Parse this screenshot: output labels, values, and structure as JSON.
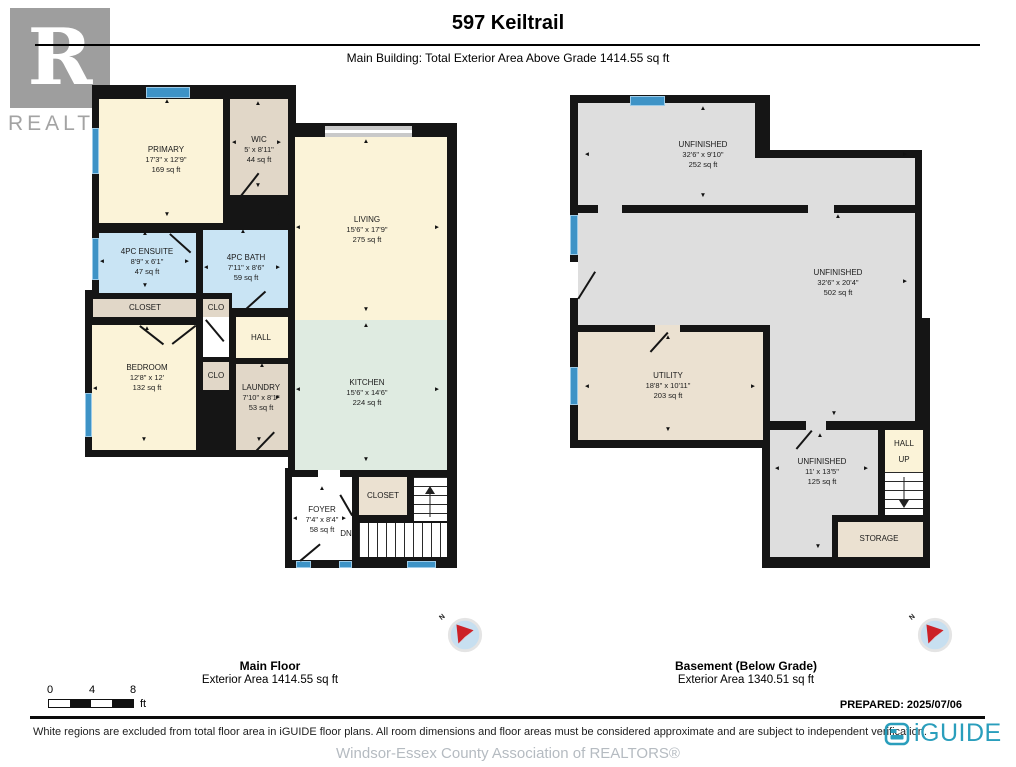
{
  "header": {
    "title": "597 Keiltrail",
    "subtitle": "Main Building: Total Exterior Area Above Grade 1414.55 sq ft"
  },
  "watermark": {
    "letter": "R",
    "label": "REALTOR",
    "reg": "®"
  },
  "colors": {
    "wall": "#151515",
    "cream": "#FBF3D8",
    "tan": "#E1D7C8",
    "tan2": "#EBE1D1",
    "bath_blue": "#C9E4F4",
    "kitchen_mint": "#DFEBE1",
    "unfinished_gray": "#DEDEDE",
    "window_blue": "#3E93C6",
    "iguide_teal": "#2A9EBC",
    "compass_red": "#CC2127"
  },
  "plans": [
    {
      "id": "main-floor",
      "caption": {
        "title": "Main Floor",
        "area": "Exterior Area 1414.55 sq ft",
        "x": 270,
        "y": 658
      },
      "compass": {
        "x": 465,
        "y": 635,
        "label": "N"
      },
      "slabs": [
        [
          92,
          85,
          204,
          242
        ],
        [
          85,
          290,
          211,
          167
        ],
        [
          288,
          123,
          169,
          357
        ],
        [
          285,
          468,
          172,
          100
        ]
      ],
      "fills": [
        {
          "k": "cream",
          "r": [
            99,
            99,
            124,
            124
          ]
        },
        {
          "k": "tan",
          "r": [
            230,
            99,
            58,
            96
          ]
        },
        {
          "k": "cream",
          "r": [
            295,
            137,
            152,
            183
          ]
        },
        {
          "k": "mint",
          "r": [
            295,
            320,
            152,
            150
          ]
        },
        {
          "k": "blue",
          "r": [
            99,
            233,
            97,
            60
          ]
        },
        {
          "k": "blue",
          "r": [
            203,
            230,
            85,
            63
          ]
        },
        {
          "k": "blue",
          "r": [
            232,
            293,
            56,
            15
          ]
        },
        {
          "k": "tan",
          "r": [
            93,
            299,
            103,
            18
          ]
        },
        {
          "k": "tan",
          "r": [
            203,
            299,
            26,
            18
          ]
        },
        {
          "k": "white",
          "r": [
            203,
            317,
            26,
            40
          ]
        },
        {
          "k": "cream",
          "r": [
            236,
            317,
            52,
            41
          ]
        },
        {
          "k": "cream",
          "r": [
            92,
            325,
            104,
            125
          ]
        },
        {
          "k": "tan",
          "r": [
            203,
            362,
            26,
            28
          ]
        },
        {
          "k": "tan",
          "r": [
            236,
            364,
            52,
            86
          ]
        },
        {
          "k": "white",
          "r": [
            292,
            477,
            60,
            83
          ]
        },
        {
          "k": "tan2",
          "r": [
            359,
            477,
            48,
            38
          ]
        },
        {
          "k": "white",
          "r": [
            318,
            470,
            22,
            8
          ]
        }
      ],
      "windows": [
        [
          146,
          87,
          44,
          11
        ],
        [
          92,
          128,
          7,
          46
        ],
        [
          92,
          238,
          7,
          42
        ],
        [
          85,
          393,
          7,
          44
        ],
        [
          296,
          561,
          15,
          7
        ],
        [
          339,
          561,
          13,
          7
        ],
        [
          407,
          561,
          29,
          7
        ]
      ],
      "sliders": [
        [
          325,
          126,
          87,
          11
        ]
      ],
      "doors": [
        {
          "x": 240,
          "y": 196,
          "len": 30,
          "deg": -52
        },
        {
          "x": 266,
          "y": 198,
          "len": 30,
          "deg": 48
        },
        {
          "x": 170,
          "y": 233,
          "len": 28,
          "deg": 42
        },
        {
          "x": 246,
          "y": 308,
          "len": 26,
          "deg": -42
        },
        {
          "x": 206,
          "y": 319,
          "len": 28,
          "deg": 50
        },
        {
          "x": 140,
          "y": 325,
          "len": 30,
          "deg": 38
        },
        {
          "x": 196,
          "y": 325,
          "len": 30,
          "deg": 142
        },
        {
          "x": 256,
          "y": 450,
          "len": 26,
          "deg": -46
        },
        {
          "x": 300,
          "y": 560,
          "len": 26,
          "deg": -40
        },
        {
          "x": 352,
          "y": 515,
          "len": 24,
          "deg": -120
        }
      ],
      "stairs": [
        {
          "r": [
            414,
            477,
            33,
            44
          ],
          "dir": "h"
        },
        {
          "r": [
            359,
            523,
            88,
            34
          ],
          "dir": "v"
        }
      ],
      "stair_arrows": [
        {
          "x": 430,
          "y1": 517,
          "y2": 487
        }
      ],
      "markers": [
        [
          "▲",
          167,
          102
        ],
        [
          "▲",
          258,
          104
        ],
        [
          "▲",
          366,
          142
        ],
        [
          "▲",
          366,
          326
        ],
        [
          "▲",
          243,
          232
        ],
        [
          "▲",
          145,
          234
        ],
        [
          "▲",
          322,
          489
        ],
        [
          "▲",
          262,
          366
        ],
        [
          "▲",
          147,
          329
        ],
        [
          "▼",
          167,
          215
        ],
        [
          "▼",
          258,
          186
        ],
        [
          "▼",
          366,
          310
        ],
        [
          "▼",
          366,
          460
        ],
        [
          "▼",
          145,
          286
        ],
        [
          "▼",
          144,
          440
        ],
        [
          "▼",
          259,
          440
        ],
        [
          "◄",
          234,
          143
        ],
        [
          "◄",
          298,
          228
        ],
        [
          "◄",
          298,
          390
        ],
        [
          "◄",
          102,
          262
        ],
        [
          "◄",
          206,
          268
        ],
        [
          "◄",
          95,
          389
        ],
        [
          "◄",
          295,
          519
        ],
        [
          "►",
          279,
          143
        ],
        [
          "►",
          437,
          228
        ],
        [
          "►",
          437,
          390
        ],
        [
          "►",
          187,
          262
        ],
        [
          "►",
          278,
          268
        ],
        [
          "►",
          278,
          398
        ],
        [
          "►",
          344,
          519
        ]
      ],
      "labels": [
        {
          "n": "PRIMARY",
          "d": "17'3\" x 12'9\"",
          "a": "169 sq ft",
          "x": 166,
          "y": 160
        },
        {
          "n": "WIC",
          "d": "5' x 8'11\"",
          "a": "44 sq ft",
          "x": 259,
          "y": 150
        },
        {
          "n": "LIVING",
          "d": "15'6\" x 17'9\"",
          "a": "275 sq ft",
          "x": 367,
          "y": 230
        },
        {
          "n": "KITCHEN",
          "d": "15'6\" x 14'6\"",
          "a": "224 sq ft",
          "x": 367,
          "y": 393
        },
        {
          "n": "4PC ENSUITE",
          "d": "8'9\" x 6'1\"",
          "a": "47 sq ft",
          "x": 147,
          "y": 262
        },
        {
          "n": "4PC BATH",
          "d": "7'11\" x 8'6\"",
          "a": "59 sq ft",
          "x": 246,
          "y": 268
        },
        {
          "n": "CLOSET",
          "x": 145,
          "y": 308
        },
        {
          "n": "CLO",
          "x": 216,
          "y": 308
        },
        {
          "n": "HALL",
          "x": 261,
          "y": 338
        },
        {
          "n": "BEDROOM",
          "d": "12'8\" x 12'",
          "a": "132 sq ft",
          "x": 147,
          "y": 378
        },
        {
          "n": "CLO",
          "x": 216,
          "y": 376
        },
        {
          "n": "LAUNDRY",
          "d": "7'10\" x 8'1\"",
          "a": "53 sq ft",
          "x": 261,
          "y": 398
        },
        {
          "n": "FOYER",
          "d": "7'4\" x 8'4\"",
          "a": "58 sq ft",
          "x": 322,
          "y": 520
        },
        {
          "n": "CLOSET",
          "x": 383,
          "y": 496
        },
        {
          "n": "DN",
          "x": 346,
          "y": 534
        }
      ]
    },
    {
      "id": "basement",
      "caption": {
        "title": "Basement (Below Grade)",
        "area": "Exterior Area 1340.51 sq ft",
        "x": 746,
        "y": 658
      },
      "compass": {
        "x": 935,
        "y": 635,
        "label": "N"
      },
      "slabs": [
        [
          570,
          95,
          200,
          117
        ],
        [
          755,
          150,
          167,
          62
        ],
        [
          570,
          205,
          352,
          127
        ],
        [
          570,
          325,
          200,
          123
        ],
        [
          762,
          318,
          168,
          250
        ]
      ],
      "fills": [
        {
          "k": "gray",
          "r": [
            578,
            103,
            177,
            55
          ]
        },
        {
          "k": "gray",
          "r": [
            578,
            158,
            337,
            47
          ]
        },
        {
          "k": "gray",
          "r": [
            578,
            213,
            337,
            112
          ]
        },
        {
          "k": "gray",
          "r": [
            770,
            325,
            145,
            96
          ]
        },
        {
          "k": "tan2",
          "r": [
            578,
            332,
            185,
            108
          ]
        },
        {
          "k": "gray",
          "r": [
            770,
            430,
            108,
            85
          ]
        },
        {
          "k": "gray",
          "r": [
            770,
            430,
            62,
            127
          ]
        },
        {
          "k": "cream",
          "r": [
            885,
            430,
            38,
            42
          ]
        },
        {
          "k": "tan2",
          "r": [
            838,
            522,
            85,
            35
          ]
        },
        {
          "k": "gray",
          "r": [
            598,
            205,
            24,
            8
          ]
        },
        {
          "k": "gray",
          "r": [
            808,
            205,
            26,
            8
          ]
        },
        {
          "k": "tan2",
          "r": [
            655,
            325,
            25,
            7
          ]
        },
        {
          "k": "gray",
          "r": [
            806,
            421,
            20,
            9
          ]
        },
        {
          "k": "white",
          "r": [
            570,
            262,
            8,
            36
          ]
        }
      ],
      "windows": [
        [
          630,
          96,
          35,
          10
        ],
        [
          570,
          215,
          8,
          40
        ],
        [
          570,
          367,
          8,
          38
        ]
      ],
      "sliders": [],
      "doors": [
        {
          "x": 578,
          "y": 298,
          "len": 32,
          "deg": -58
        },
        {
          "x": 668,
          "y": 332,
          "len": 26,
          "deg": 132
        },
        {
          "x": 812,
          "y": 430,
          "len": 24,
          "deg": 130
        }
      ],
      "stairs": [
        {
          "r": [
            885,
            472,
            38,
            43
          ],
          "dir": "h"
        }
      ],
      "stair_arrows": [
        {
          "x": 904,
          "y1": 477,
          "y2": 507
        }
      ],
      "markers": [
        [
          "▲",
          703,
          109
        ],
        [
          "▲",
          838,
          217
        ],
        [
          "▲",
          668,
          338
        ],
        [
          "▲",
          820,
          436
        ],
        [
          "▼",
          703,
          196
        ],
        [
          "▼",
          834,
          414
        ],
        [
          "▼",
          668,
          430
        ],
        [
          "▼",
          818,
          547
        ],
        [
          "◄",
          587,
          155
        ],
        [
          "◄",
          587,
          387
        ],
        [
          "◄",
          777,
          469
        ],
        [
          "►",
          905,
          155
        ],
        [
          "►",
          905,
          282
        ],
        [
          "►",
          753,
          387
        ],
        [
          "►",
          866,
          469
        ]
      ],
      "labels": [
        {
          "n": "UNFINISHED",
          "d": "32'6\" x 9'10\"",
          "a": "252 sq ft",
          "x": 703,
          "y": 155
        },
        {
          "n": "UNFINISHED",
          "d": "32'6\" x 20'4\"",
          "a": "502 sq ft",
          "x": 838,
          "y": 283
        },
        {
          "n": "UTILITY",
          "d": "18'8\" x 10'11\"",
          "a": "203 sq ft",
          "x": 668,
          "y": 386
        },
        {
          "n": "UNFINISHED",
          "d": "11' x 13'5\"",
          "a": "125 sq ft",
          "x": 822,
          "y": 472
        },
        {
          "n": "HALL",
          "x": 904,
          "y": 444
        },
        {
          "n": "UP",
          "x": 904,
          "y": 460
        },
        {
          "n": "STORAGE",
          "x": 879,
          "y": 539
        }
      ]
    }
  ],
  "scalebar": {
    "ticks": [
      "0",
      "4",
      "8"
    ],
    "unit": "ft"
  },
  "prepared": "PREPARED: 2025/07/06",
  "footer": {
    "disclaimer": "White regions are excluded from total floor area in iGUIDE floor plans. All room dimensions and floor areas must be considered approximate and are subject to independent verification.",
    "brand": "iGUIDE",
    "association": "Windsor-Essex County Association of REALTORS®"
  }
}
